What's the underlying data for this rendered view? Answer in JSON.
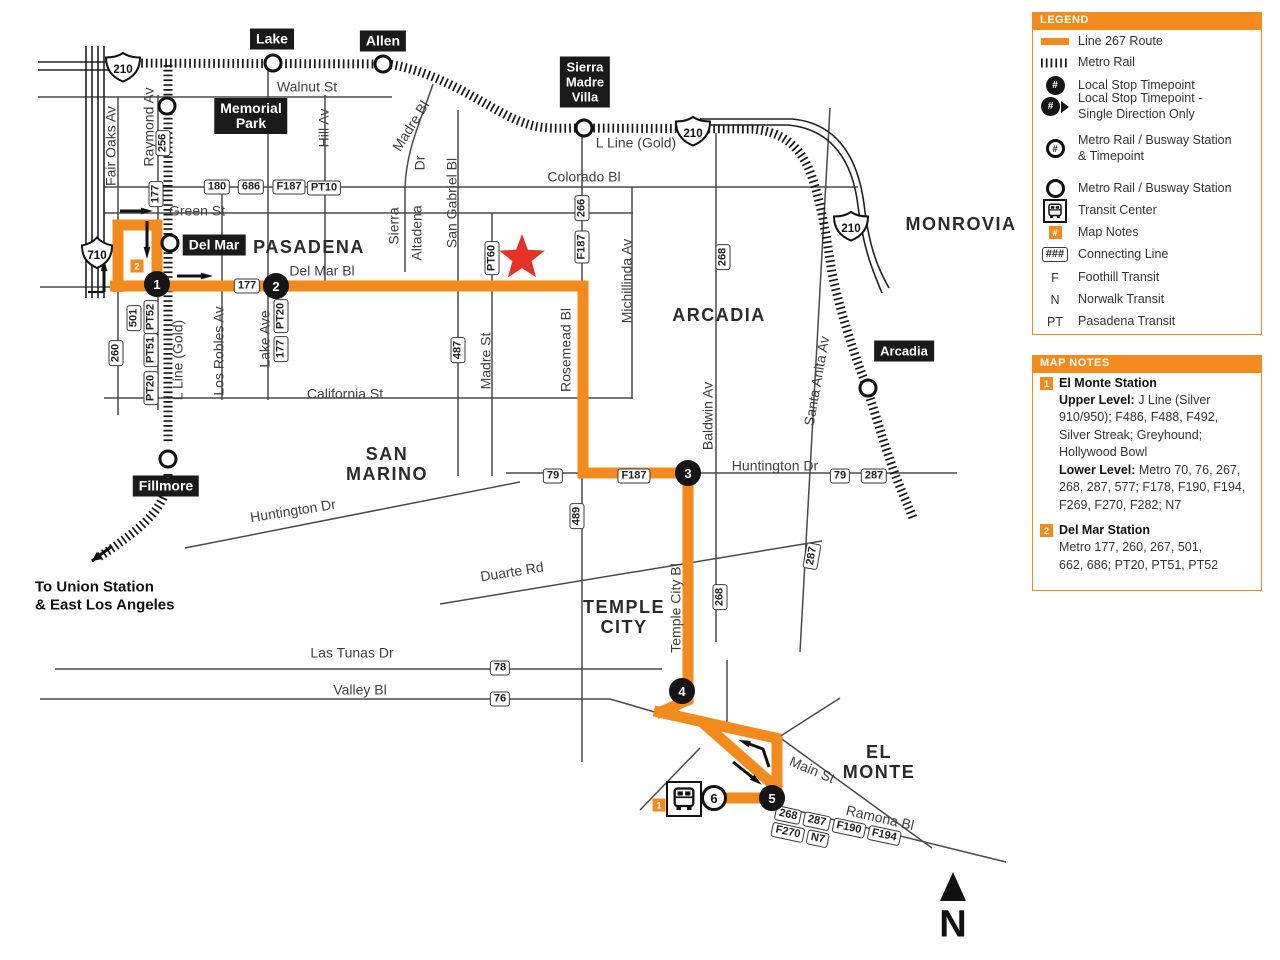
{
  "colors": {
    "orange": "#F28A1E",
    "black": "#151515",
    "street": "#4a4a4a",
    "red": "#E53226",
    "label": "#3f3f3f"
  },
  "legend": {
    "title": "LEGEND",
    "items": [
      {
        "icon": "route-line",
        "y": 41,
        "lines": [
          "Line 267 Route"
        ]
      },
      {
        "icon": "rail",
        "y": 62,
        "lines": [
          "Metro Rail"
        ]
      },
      {
        "icon": "stop-timepoint",
        "y": 85,
        "lines": [
          "Local Stop Timepoint"
        ]
      },
      {
        "icon": "stop-timepoint-single",
        "y": 106,
        "lines": [
          "Local Stop Timepoint -",
          "Single Direction Only"
        ]
      },
      {
        "icon": "station-timepoint",
        "y": 148,
        "lines": [
          "Metro Rail / Busway Station",
          "& Timepoint"
        ]
      },
      {
        "icon": "station",
        "y": 188,
        "lines": [
          "Metro Rail / Busway Station"
        ]
      },
      {
        "icon": "transit-center",
        "y": 210,
        "lines": [
          "Transit Center"
        ]
      },
      {
        "icon": "map-note",
        "y": 232,
        "lines": [
          "Map Notes"
        ]
      },
      {
        "icon": "connecting",
        "y": 254,
        "lines": [
          "Connecting Line"
        ]
      },
      {
        "icon": "F",
        "y": 277,
        "lines": [
          "Foothill Transit"
        ]
      },
      {
        "icon": "N",
        "y": 299,
        "lines": [
          "Norwalk Transit"
        ]
      },
      {
        "icon": "PT",
        "y": 321,
        "lines": [
          "Pasadena Transit"
        ]
      }
    ],
    "hash": "#",
    "hashes": "###",
    "box_top": 12,
    "box_bottom": 335
  },
  "map_notes": {
    "title": "MAP NOTES",
    "box_top": 355,
    "box_bottom": 591,
    "notes": [
      {
        "num": "1",
        "sq_y": 383,
        "title": "El Monte Station",
        "title_y": 384,
        "lines": [
          {
            "y": 401,
            "bold": "Upper Level:",
            "text": " J Line (Silver"
          },
          {
            "y": 418,
            "text": "910/950); F486, F488, F492,"
          },
          {
            "y": 436,
            "text": "Silver Streak; Greyhound;"
          },
          {
            "y": 453,
            "text": "Hollywood Bowl"
          },
          {
            "y": 471,
            "bold": "Lower Level:",
            "text": " Metro 70, 76, 267,"
          },
          {
            "y": 488,
            "text": "268, 287, 577; F178, F190, F194,"
          },
          {
            "y": 506,
            "text": "F269, F270, F282; N7"
          }
        ]
      },
      {
        "num": "2",
        "sq_y": 530,
        "title": "Del Mar Station",
        "title_y": 531,
        "lines": [
          {
            "y": 548,
            "text": "Metro 177, 260, 267, 501,"
          },
          {
            "y": 566,
            "text": "662, 686; PT20, PT51, PT52"
          }
        ]
      }
    ]
  },
  "map": {
    "cities": [
      {
        "label": "PASADENA",
        "x": 309,
        "y": 247
      },
      {
        "label": "MONROVIA",
        "x": 961,
        "y": 224
      },
      {
        "label": "ARCADIA",
        "x": 719,
        "y": 315
      },
      {
        "label": "SAN\nMARINO",
        "x": 387,
        "y": 464
      },
      {
        "label": "TEMPLE\nCITY",
        "x": 624,
        "y": 617
      },
      {
        "label": "EL\nMONTE",
        "x": 879,
        "y": 762
      }
    ],
    "street_labels": [
      {
        "text": "Walnut St",
        "x": 307,
        "y": 87
      },
      {
        "text": "Colorado Bl",
        "x": 584,
        "y": 177
      },
      {
        "text": "Green St",
        "x": 197,
        "y": 211
      },
      {
        "text": "Del Mar Bl",
        "x": 322,
        "y": 271
      },
      {
        "text": "California St",
        "x": 345,
        "y": 394
      },
      {
        "text": "Huntington Dr",
        "x": 775,
        "y": 466
      },
      {
        "text": "Huntington Dr",
        "x": 293,
        "y": 511,
        "rot": -9
      },
      {
        "text": "Duarte Rd",
        "x": 512,
        "y": 572,
        "rot": -9
      },
      {
        "text": "Las Tunas Dr",
        "x": 352,
        "y": 653
      },
      {
        "text": "Valley Bl",
        "x": 360,
        "y": 690
      },
      {
        "text": "Main St",
        "x": 812,
        "y": 770,
        "rot": 23
      },
      {
        "text": "Ramona Bl",
        "x": 880,
        "y": 818,
        "rot": 13
      },
      {
        "text": "L Line (Gold)",
        "x": 636,
        "y": 143
      },
      {
        "text": "Fair Oaks Av",
        "x": 111,
        "y": 146,
        "rot": -90
      },
      {
        "text": "Raymond Av",
        "x": 149,
        "y": 127,
        "rot": -90
      },
      {
        "text": "Hill Av",
        "x": 324,
        "y": 128,
        "rot": -90
      },
      {
        "text": "Madre Bl",
        "x": 411,
        "y": 126,
        "rot": -58
      },
      {
        "text": "Dr",
        "x": 420,
        "y": 163,
        "rot": -90
      },
      {
        "text": "Sierra",
        "x": 394,
        "y": 226,
        "rot": -90
      },
      {
        "text": "Altadena",
        "x": 417,
        "y": 233,
        "rot": -90
      },
      {
        "text": "San Gabriel Bl",
        "x": 452,
        "y": 203,
        "rot": -90
      },
      {
        "text": "Madre St",
        "x": 486,
        "y": 361,
        "rot": -90
      },
      {
        "text": "Rosemead Bl",
        "x": 566,
        "y": 350,
        "rot": -90
      },
      {
        "text": "Michillinda Av",
        "x": 627,
        "y": 281,
        "rot": -90
      },
      {
        "text": "Baldwin Av",
        "x": 708,
        "y": 416,
        "rot": -90
      },
      {
        "text": "Santa Anita Av",
        "x": 817,
        "y": 381,
        "rot": -80
      },
      {
        "text": "Temple City Bl",
        "x": 676,
        "y": 608,
        "rot": -90
      },
      {
        "text": "Los Robles Av",
        "x": 219,
        "y": 351,
        "rot": -90
      },
      {
        "text": "Lake Ave",
        "x": 265,
        "y": 339,
        "rot": -90
      },
      {
        "text": "L Line (Gold)",
        "x": 178,
        "y": 360,
        "rot": -90
      }
    ],
    "dest_text": {
      "lines": [
        "To Union Station",
        "& East Los Angeles"
      ],
      "x": 35,
      "y1": 587,
      "y2": 605
    },
    "badges": [
      {
        "text": "180",
        "x": 217,
        "y": 187
      },
      {
        "text": "686",
        "x": 251,
        "y": 187
      },
      {
        "text": "F187",
        "x": 289,
        "y": 187
      },
      {
        "text": "PT10",
        "x": 324,
        "y": 188
      },
      {
        "text": "177",
        "x": 247,
        "y": 286
      },
      {
        "text": "79",
        "x": 553,
        "y": 476
      },
      {
        "text": "F187",
        "x": 634,
        "y": 476
      },
      {
        "text": "79",
        "x": 840,
        "y": 476
      },
      {
        "text": "287",
        "x": 874,
        "y": 476
      },
      {
        "text": "78",
        "x": 500,
        "y": 668
      },
      {
        "text": "76",
        "x": 500,
        "y": 699
      },
      {
        "text": "256",
        "x": 163,
        "y": 143,
        "rot": -90
      },
      {
        "text": "177",
        "x": 156,
        "y": 194,
        "rot": -90
      },
      {
        "text": "501",
        "x": 134,
        "y": 318,
        "rot": -90
      },
      {
        "text": "PT52",
        "x": 151,
        "y": 317,
        "rot": -90
      },
      {
        "text": "PT51",
        "x": 151,
        "y": 350,
        "rot": -90
      },
      {
        "text": "PT20",
        "x": 151,
        "y": 388,
        "rot": -90
      },
      {
        "text": "260",
        "x": 116,
        "y": 353,
        "rot": -90
      },
      {
        "text": "PT20",
        "x": 281,
        "y": 316,
        "rot": -90
      },
      {
        "text": "177",
        "x": 281,
        "y": 349,
        "rot": -90
      },
      {
        "text": "487",
        "x": 458,
        "y": 350,
        "rot": -90
      },
      {
        "text": "PT60",
        "x": 492,
        "y": 258,
        "rot": -90
      },
      {
        "text": "266",
        "x": 582,
        "y": 208,
        "rot": -90
      },
      {
        "text": "F187",
        "x": 582,
        "y": 247,
        "rot": -90
      },
      {
        "text": "489",
        "x": 577,
        "y": 516,
        "rot": -90
      },
      {
        "text": "268",
        "x": 723,
        "y": 257,
        "rot": -90
      },
      {
        "text": "268",
        "x": 720,
        "y": 597,
        "rot": -90
      },
      {
        "text": "287",
        "x": 812,
        "y": 556,
        "rot": -80
      }
    ],
    "badge_cluster": {
      "x": 836,
      "y": 834,
      "rows": [
        [
          "268",
          "287",
          "F190",
          "F194"
        ],
        [
          "F270",
          "N7"
        ]
      ]
    },
    "stations": [
      {
        "label": "Lake",
        "x": 272,
        "y": 39
      },
      {
        "label": "Allen",
        "x": 383,
        "y": 41
      },
      {
        "label": "Memorial\nPark",
        "x": 251,
        "y": 116
      },
      {
        "label": "Sierra\nMadre\nVilla",
        "x": 585,
        "y": 82,
        "size": 13
      },
      {
        "label": "Del Mar",
        "x": 214,
        "y": 245
      },
      {
        "label": "Fillmore",
        "x": 166,
        "y": 486
      },
      {
        "label": "Arcadia",
        "x": 904,
        "y": 351,
        "size": 13
      }
    ],
    "station_circles": [
      {
        "x": 273,
        "y": 63
      },
      {
        "x": 383,
        "y": 64
      },
      {
        "x": 167,
        "y": 106
      },
      {
        "x": 584,
        "y": 128
      },
      {
        "x": 170,
        "y": 243
      },
      {
        "x": 168,
        "y": 459
      },
      {
        "x": 868,
        "y": 388
      }
    ],
    "stops": [
      {
        "n": "1",
        "x": 157,
        "y": 284,
        "type": "solid"
      },
      {
        "n": "2",
        "x": 276,
        "y": 286,
        "type": "solid"
      },
      {
        "n": "3",
        "x": 688,
        "y": 473,
        "type": "solid"
      },
      {
        "n": "4",
        "x": 682,
        "y": 691,
        "type": "solid"
      },
      {
        "n": "5",
        "x": 772,
        "y": 798,
        "type": "solid"
      },
      {
        "n": "6",
        "x": 714,
        "y": 798,
        "type": "open"
      }
    ],
    "note_squares": [
      {
        "n": "2",
        "x": 137,
        "y": 266
      },
      {
        "n": "1",
        "x": 659,
        "y": 805
      }
    ],
    "shields": [
      {
        "kind": "interstate",
        "num": "210",
        "x": 123,
        "y": 67
      },
      {
        "kind": "interstate",
        "num": "210",
        "x": 693,
        "y": 131
      },
      {
        "kind": "interstate",
        "num": "210",
        "x": 851,
        "y": 226
      },
      {
        "kind": "state",
        "num": "710",
        "x": 97,
        "y": 252
      }
    ],
    "north": {
      "label": "N",
      "x": 953,
      "y": 925,
      "tri_y": 887
    },
    "star": {
      "x": 522,
      "y": 258,
      "r": 24
    },
    "transit_center": {
      "x": 684,
      "y": 799
    },
    "geometry": {
      "streets_h": [
        [
          38,
          97,
          392
        ],
        [
          104,
          187,
          858
        ],
        [
          104,
          213,
          633
        ],
        [
          40,
          287,
          112
        ],
        [
          104,
          398,
          633
        ],
        [
          506,
          473,
          957
        ],
        [
          55,
          669,
          662
        ],
        [
          40,
          699,
          610
        ]
      ],
      "streets_v": [
        [
          118,
          97,
          415
        ],
        [
          158,
          95,
          410
        ],
        [
          222,
          187,
          400
        ],
        [
          268,
          64,
          400
        ],
        [
          325,
          95,
          288
        ],
        [
          458,
          110,
          476
        ],
        [
          492,
          213,
          476
        ],
        [
          582,
          130,
          287
        ],
        [
          582,
          472,
          762
        ],
        [
          632,
          187,
          399
        ],
        [
          716,
          133,
          642
        ],
        [
          727,
          660,
          727
        ]
      ],
      "streets_d": [
        [
          185,
          548,
          520,
          482
        ],
        [
          440,
          604,
          822,
          541
        ],
        [
          830,
          108,
          800,
          652
        ],
        [
          610,
          699,
          658,
          713
        ],
        [
          840,
          698,
          779,
          737
        ],
        [
          779,
          737,
          932,
          848
        ],
        [
          770,
          804,
          1006,
          862
        ],
        [
          700,
          748,
          640,
          810
        ]
      ],
      "street_paths": [
        "M433 84 C421 120 406 150 405 188 L405 272"
      ],
      "rail_paths": [
        "M122 63 L388 64 C437 72 470 96 508 116 C538 131 552 128 584 128 L752 129 C788 132 804 152 813 180 C822 207 827 240 832 273 C840 310 851 345 863 377 C872 402 881 435 890 460 C899 487 906 500 913 518",
        "M168 65 L168 444",
        "M168 474 C168 505 146 524 114 547 L99 557"
      ],
      "rail_arrow": [
        [
          112,
          546
        ],
        [
          92,
          561
        ]
      ],
      "freeway_lines": [
        [
          38,
          62,
          118,
          62
        ],
        [
          38,
          70,
          118,
          70
        ],
        [
          86,
          46,
          86,
          298
        ],
        [
          92,
          46,
          92,
          298
        ],
        [
          98,
          46,
          98,
          298
        ],
        [
          104,
          46,
          104,
          298
        ]
      ],
      "freeway_paths": [
        "M700 119 L792 119 C838 123 858 159 864 204 C869 246 877 267 889 288",
        "M700 125 L788 125 C833 129 853 163 858 206 C863 246 871 267 882 293"
      ],
      "route_paths": [
        "M118 292 L118 225 L157 225 L157 292",
        "M110 286 L583 286 L583 473 L688 473 L688 700 L656 714",
        "M654 711 L780 739",
        "M777 736 L777 799",
        "M702 722 L778 789",
        "M687 798 L778 798"
      ],
      "arrows": [
        [
          [
            120,
            211
          ],
          [
            147,
            211
          ]
        ],
        [
          [
            147,
            221
          ],
          [
            147,
            253
          ]
        ],
        [
          [
            104,
            292
          ],
          [
            104,
            265
          ]
        ],
        [
          [
            177,
            276
          ],
          [
            207,
            276
          ]
        ],
        [
          [
            769,
            767
          ],
          [
            763,
            749
          ],
          [
            744,
            742
          ]
        ],
        [
          [
            733,
            762
          ],
          [
            757,
            781
          ]
        ]
      ],
      "plain_lines": [
        [
          88,
          292,
          104,
          292
        ]
      ]
    }
  }
}
